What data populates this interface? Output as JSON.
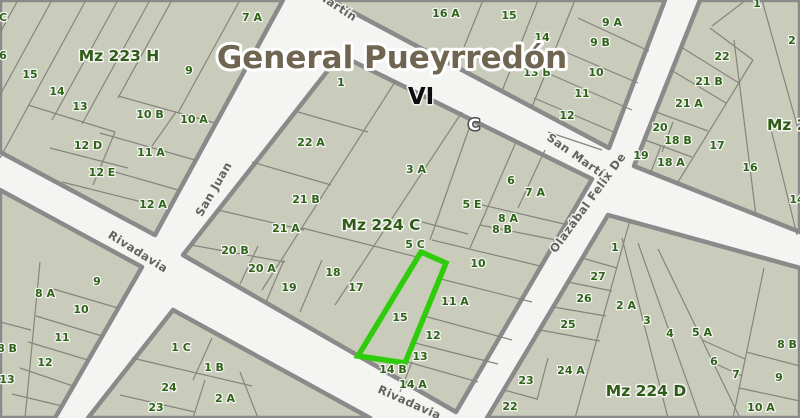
{
  "map": {
    "title": "General Pueyrredón",
    "zone_label": "VI",
    "section_label": "C",
    "colors": {
      "block_fill": "#c9ccba",
      "street_fill": "#f4f4f2",
      "block_border": "#8a8a8a",
      "parcel_line": "#85857d",
      "parcel_text": "#2e6318",
      "block_text": "#2f5c16",
      "street_text": "#62625e",
      "title_text": "#6f6550",
      "highlight": "#2ecc0a"
    },
    "highlighted_parcel": {
      "id": "15",
      "block": "Mz 224 C"
    },
    "blocks": [
      {
        "name": "mz-223-h",
        "label": "Mz 223 H",
        "parcels": [
          {
            "id": "C",
            "x": 3,
            "y": 17
          },
          {
            "id": "6",
            "x": 3,
            "y": 55
          },
          {
            "id": "15",
            "x": 30,
            "y": 74
          },
          {
            "id": "14",
            "x": 57,
            "y": 91
          },
          {
            "id": "13",
            "x": 80,
            "y": 106
          },
          {
            "id": "12 D",
            "x": 88,
            "y": 145
          },
          {
            "id": "12 E",
            "x": 102,
            "y": 172
          },
          {
            "id": "12 A",
            "x": 153,
            "y": 204
          },
          {
            "id": "11 A",
            "x": 151,
            "y": 152
          },
          {
            "id": "10 B",
            "x": 150,
            "y": 114
          },
          {
            "id": "10 A",
            "x": 194,
            "y": 119
          },
          {
            "id": "9",
            "x": 189,
            "y": 70
          },
          {
            "id": "7 A",
            "x": 252,
            "y": 17
          }
        ]
      },
      {
        "name": "block-north-center",
        "label": "",
        "parcels": [
          {
            "id": "16 A",
            "x": 446,
            "y": 13
          },
          {
            "id": "15",
            "x": 509,
            "y": 15
          },
          {
            "id": "14",
            "x": 542,
            "y": 37
          },
          {
            "id": "13 B",
            "x": 537,
            "y": 72
          },
          {
            "id": "9 A",
            "x": 612,
            "y": 22
          },
          {
            "id": "9 B",
            "x": 600,
            "y": 42
          },
          {
            "id": "10",
            "x": 596,
            "y": 72
          },
          {
            "id": "11",
            "x": 582,
            "y": 93
          },
          {
            "id": "12",
            "x": 567,
            "y": 115
          }
        ]
      },
      {
        "name": "mz-224-c",
        "label": "Mz 224 C",
        "parcels": [
          {
            "id": "1",
            "x": 341,
            "y": 82
          },
          {
            "id": "22 A",
            "x": 311,
            "y": 142
          },
          {
            "id": "3 A",
            "x": 416,
            "y": 169
          },
          {
            "id": "21 B",
            "x": 306,
            "y": 199
          },
          {
            "id": "21 A",
            "x": 286,
            "y": 228
          },
          {
            "id": "20 B",
            "x": 235,
            "y": 250
          },
          {
            "id": "20 A",
            "x": 262,
            "y": 268
          },
          {
            "id": "19",
            "x": 289,
            "y": 287
          },
          {
            "id": "18",
            "x": 333,
            "y": 272
          },
          {
            "id": "17",
            "x": 356,
            "y": 287
          },
          {
            "id": "5 E",
            "x": 472,
            "y": 204
          },
          {
            "id": "6",
            "x": 511,
            "y": 180
          },
          {
            "id": "7 A",
            "x": 535,
            "y": 192
          },
          {
            "id": "8 A",
            "x": 508,
            "y": 218
          },
          {
            "id": "8 B",
            "x": 502,
            "y": 229
          },
          {
            "id": "5 C",
            "x": 415,
            "y": 244
          },
          {
            "id": "10",
            "x": 478,
            "y": 263
          },
          {
            "id": "11 A",
            "x": 455,
            "y": 301
          },
          {
            "id": "12",
            "x": 433,
            "y": 335
          },
          {
            "id": "13",
            "x": 420,
            "y": 356
          },
          {
            "id": "15",
            "x": 400,
            "y": 317
          },
          {
            "id": "14 B",
            "x": 393,
            "y": 369
          },
          {
            "id": "14 A",
            "x": 413,
            "y": 384
          }
        ]
      },
      {
        "name": "mz-224-d",
        "label": "Mz 224 D",
        "parcels": [
          {
            "id": "1",
            "x": 615,
            "y": 247
          },
          {
            "id": "27",
            "x": 598,
            "y": 276
          },
          {
            "id": "26",
            "x": 584,
            "y": 298
          },
          {
            "id": "25",
            "x": 568,
            "y": 324
          },
          {
            "id": "24 A",
            "x": 571,
            "y": 370
          },
          {
            "id": "23",
            "x": 526,
            "y": 380
          },
          {
            "id": "22",
            "x": 510,
            "y": 406
          },
          {
            "id": "2 A",
            "x": 626,
            "y": 305
          },
          {
            "id": "3",
            "x": 647,
            "y": 320
          },
          {
            "id": "4",
            "x": 670,
            "y": 333
          },
          {
            "id": "5 A",
            "x": 702,
            "y": 332
          },
          {
            "id": "6",
            "x": 714,
            "y": 361
          },
          {
            "id": "7",
            "x": 736,
            "y": 374
          },
          {
            "id": "8 B",
            "x": 787,
            "y": 344
          },
          {
            "id": "9",
            "x": 779,
            "y": 377
          },
          {
            "id": "10 A",
            "x": 761,
            "y": 407
          }
        ]
      },
      {
        "name": "block-south-west",
        "label": "",
        "parcels": [
          {
            "id": "9",
            "x": 97,
            "y": 281
          },
          {
            "id": "8 A",
            "x": 45,
            "y": 293
          },
          {
            "id": "10",
            "x": 81,
            "y": 309
          },
          {
            "id": "11",
            "x": 62,
            "y": 337
          },
          {
            "id": "12",
            "x": 45,
            "y": 362
          },
          {
            "id": "8 B",
            "x": 7,
            "y": 348
          },
          {
            "id": "13",
            "x": 7,
            "y": 379
          }
        ]
      },
      {
        "name": "block-south-center",
        "label": "",
        "parcels": [
          {
            "id": "1 C",
            "x": 181,
            "y": 347
          },
          {
            "id": "1 B",
            "x": 214,
            "y": 367
          },
          {
            "id": "24",
            "x": 169,
            "y": 387
          },
          {
            "id": "23",
            "x": 156,
            "y": 407
          },
          {
            "id": "2 A",
            "x": 225,
            "y": 398
          }
        ]
      },
      {
        "name": "mz-2-northeast",
        "label": "Mz 2",
        "parcels": [
          {
            "id": "1",
            "x": 757,
            "y": 3
          },
          {
            "id": "2",
            "x": 792,
            "y": 40
          },
          {
            "id": "22",
            "x": 722,
            "y": 56
          },
          {
            "id": "21 B",
            "x": 709,
            "y": 81
          },
          {
            "id": "21 A",
            "x": 689,
            "y": 103
          },
          {
            "id": "20",
            "x": 660,
            "y": 127
          },
          {
            "id": "18 B",
            "x": 678,
            "y": 140
          },
          {
            "id": "19",
            "x": 641,
            "y": 155
          },
          {
            "id": "18 A",
            "x": 671,
            "y": 162
          },
          {
            "id": "17",
            "x": 717,
            "y": 145
          },
          {
            "id": "16",
            "x": 750,
            "y": 167
          },
          {
            "id": "14",
            "x": 797,
            "y": 199
          }
        ]
      }
    ],
    "streets": [
      {
        "name": "San Martín",
        "x": 322,
        "y": -3,
        "angle": 33
      },
      {
        "name": "San Martín",
        "x": 577,
        "y": 157,
        "angle": 35
      },
      {
        "name": "San Juan",
        "x": 217,
        "y": 187,
        "angle": -60
      },
      {
        "name": "Olazábal Felix De",
        "x": 591,
        "y": 201,
        "angle": -54
      },
      {
        "name": "Rivadavia",
        "x": 136,
        "y": 251,
        "angle": 32
      },
      {
        "name": "Rivadavia",
        "x": 408,
        "y": 402,
        "angle": 24
      }
    ]
  }
}
